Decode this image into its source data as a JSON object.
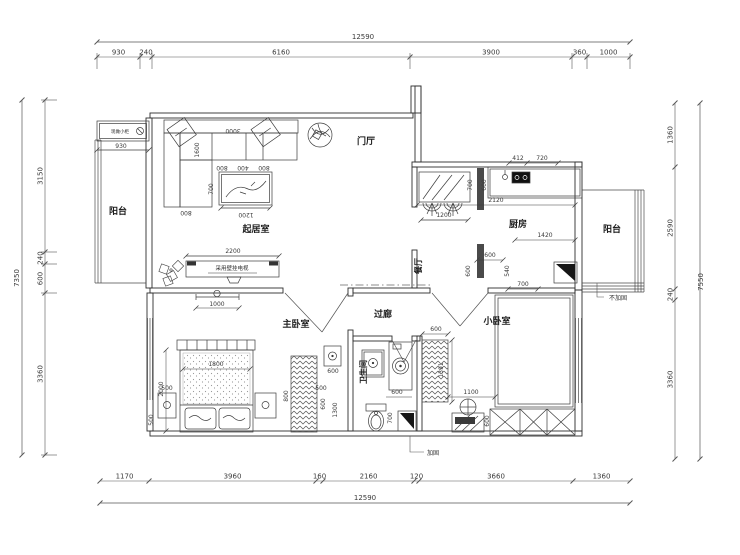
{
  "rooms": {
    "entry": "门厅",
    "living": "起居室",
    "balcony_left": "阳台",
    "balcony_right": "阳台",
    "dining": "餐厅",
    "kitchen": "厨房",
    "master_bedroom": "主卧室",
    "corridor": "过廊",
    "small_bedroom": "小卧室",
    "bathroom": "卫生间"
  },
  "notes": {
    "cabinet": "现做小柜",
    "tv": "采用壁挂电视",
    "no_reinforce": "不加固",
    "reinforce": "加固"
  },
  "dims": {
    "top": {
      "overall": "12590",
      "segments": [
        "930",
        "240",
        "6160",
        "3900",
        "360",
        "1000"
      ]
    },
    "bottom": {
      "overall": "12590",
      "segments": [
        "1170",
        "3960",
        "160",
        "2160",
        "120",
        "3660",
        "1360"
      ]
    },
    "left": {
      "overall": "7350",
      "segments": [
        "3150",
        "240",
        "600",
        "3360"
      ]
    },
    "right": {
      "overall": "7550",
      "segments": [
        "1360",
        "2590",
        "240",
        "3360"
      ]
    },
    "interior": {
      "sofa_width": "3000",
      "sofa_depth": "1600",
      "sofa_seat_a": "800",
      "sofa_seat_b": "400",
      "sofa_seat_c": "800",
      "sofa_chaise": "800",
      "table_depth": "700",
      "table_width": "1200",
      "tv_wall": "2200",
      "ceiling_light": "1000",
      "balcony_cabinet": "930",
      "kitchen_top_a": "412",
      "kitchen_top_b": "720",
      "kitchen_mirror_depth": "700",
      "kitchen_600a": "600",
      "kitchen_2120": "2120",
      "kitchen_1420": "1420",
      "kitchen_600b": "600",
      "kitchen_540": "540",
      "kitchen_600c": "600",
      "kitchen_700": "700",
      "dining_width": "1200",
      "bed_width": "1800",
      "bed_length": "2000",
      "bed_side_l": "500",
      "bed_side_r": "500",
      "bed_corner": "500",
      "master_600": "600",
      "master_1300": "1300",
      "master_box": "600",
      "master_wardrobe": "800",
      "bath_niche": "600",
      "wardrobe_h": "1391",
      "bath_600": "600",
      "bath_700": "700",
      "small_1100": "1100",
      "small_600": "600"
    }
  }
}
